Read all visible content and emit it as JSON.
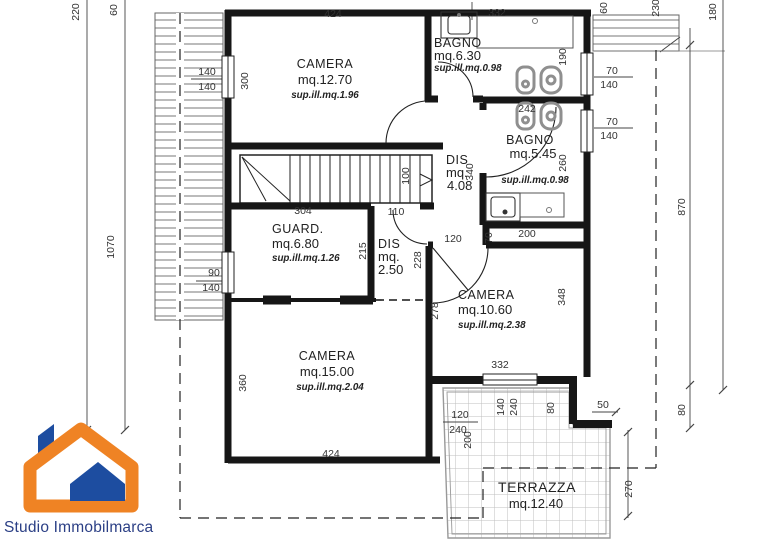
{
  "branding": {
    "name": "Studio Immobilmarca"
  },
  "rooms": {
    "camera1": {
      "name": "CAMERA",
      "area": "mq.12.70",
      "sup": "sup.ill.mq.1.96"
    },
    "bagno1": {
      "name": "BAGNO",
      "area": "mq.6.30",
      "sup": "sup.ill.mq.0.98"
    },
    "bagno2": {
      "name": "BAGNO",
      "area": "mq.5.45",
      "sup": "sup.ill.mq.0.98"
    },
    "dis1": {
      "name": "DIS",
      "l2": "mq.",
      "l3": "4.08"
    },
    "guard": {
      "name": "GUARD.",
      "area": "mq.6.80",
      "sup": "sup.ill.mq.1.26"
    },
    "dis2": {
      "name": "DIS",
      "l2": "mq.",
      "l3": "2.50"
    },
    "camera2": {
      "name": "CAMERA",
      "area": "mq.10.60",
      "sup": "sup.ill.mq.2.38"
    },
    "camera3": {
      "name": "CAMERA",
      "area": "mq.15.00",
      "sup": "sup.ill.mq.2.04"
    },
    "terrazza": {
      "name": "TERRAZZA",
      "area": "mq.12.40"
    }
  },
  "dims": {
    "top_424": "424",
    "top_332": "332",
    "tl_220": "220",
    "tl_60": "60",
    "tr_60": "60",
    "tr_230": "230",
    "tr_180": "180",
    "winl1_a": "140",
    "winl1_b": "140",
    "v300": "300",
    "v190": "190",
    "winr1_a": "70",
    "winr1_b": "140",
    "winr2_a": "70",
    "winr2_b": "140",
    "d242": "242",
    "v260": "260",
    "v340": "340",
    "v100": "100",
    "d110": "110",
    "d304": "304",
    "v215": "215",
    "v228": "228",
    "d120": "120",
    "d200": "200",
    "v70": "70",
    "v278": "278",
    "v348": "348",
    "d332b": "332",
    "winl2_a": "90",
    "winl2_b": "140",
    "v360": "360",
    "bot_424": "424",
    "v1070": "1070",
    "v870": "870",
    "v80": "80",
    "t120": "120",
    "t240": "240",
    "t200": "200",
    "t140": "140",
    "t240b": "240",
    "t80": "80",
    "d50": "50",
    "v270": "270"
  }
}
